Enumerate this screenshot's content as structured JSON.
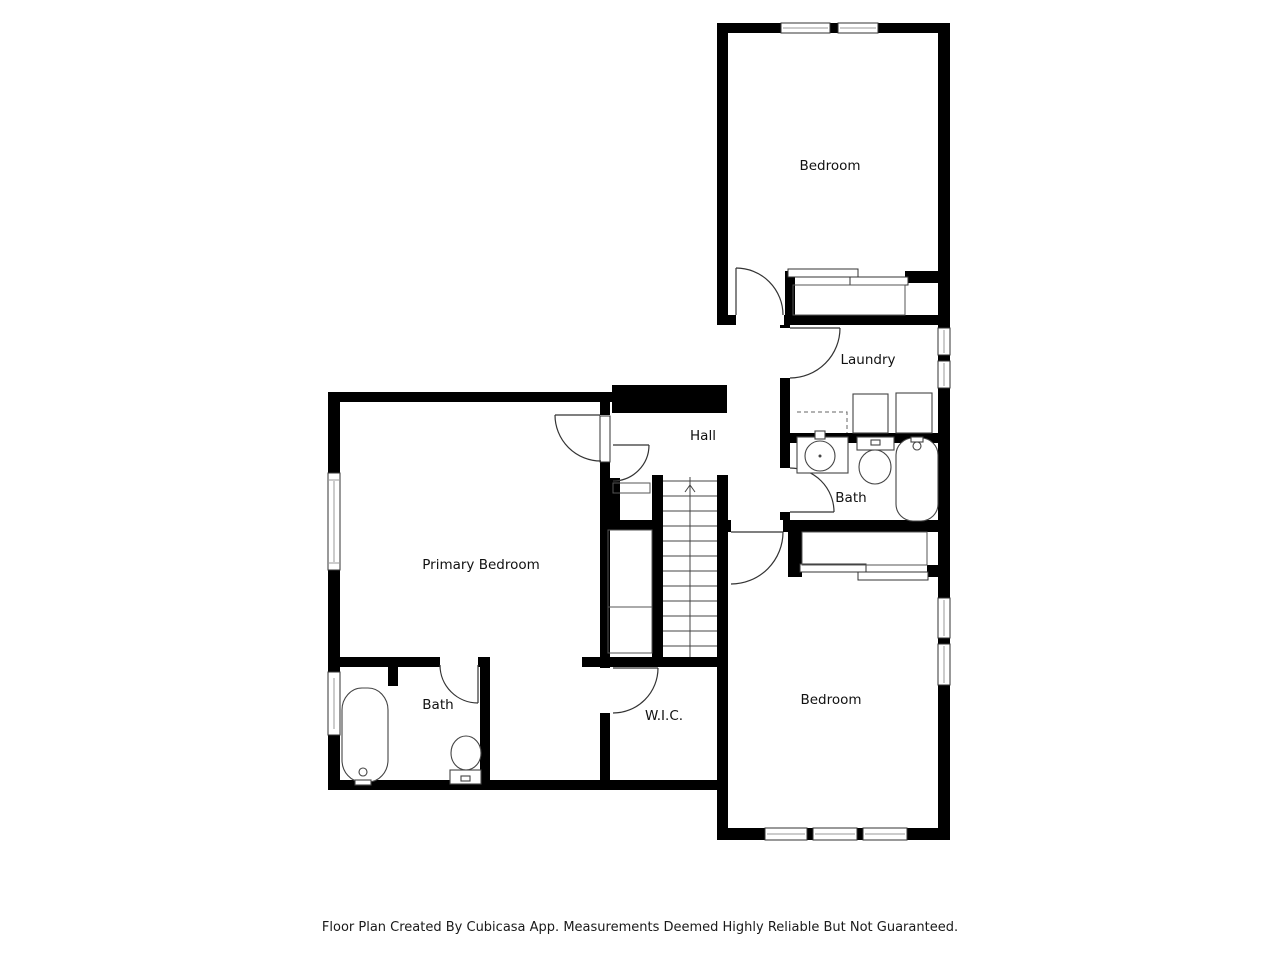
{
  "floor_plan": {
    "rooms": [
      {
        "id": "bedroom-top",
        "name": "Bedroom"
      },
      {
        "id": "laundry",
        "name": "Laundry"
      },
      {
        "id": "hall",
        "name": "Hall"
      },
      {
        "id": "bath-right",
        "name": "Bath"
      },
      {
        "id": "primary-bedroom",
        "name": "Primary Bedroom"
      },
      {
        "id": "bedroom-bottom",
        "name": "Bedroom"
      },
      {
        "id": "bath-left",
        "name": "Bath"
      },
      {
        "id": "wic",
        "name": "W.I.C."
      }
    ],
    "stairs": {
      "direction_icon": "up-arrow"
    },
    "footer": "Floor Plan Created By Cubicasa App. Measurements Deemed Highly Reliable But Not Guaranteed.",
    "colors": {
      "wall": "#000000",
      "fixture_line": "#444444",
      "background": "#ffffff"
    }
  }
}
